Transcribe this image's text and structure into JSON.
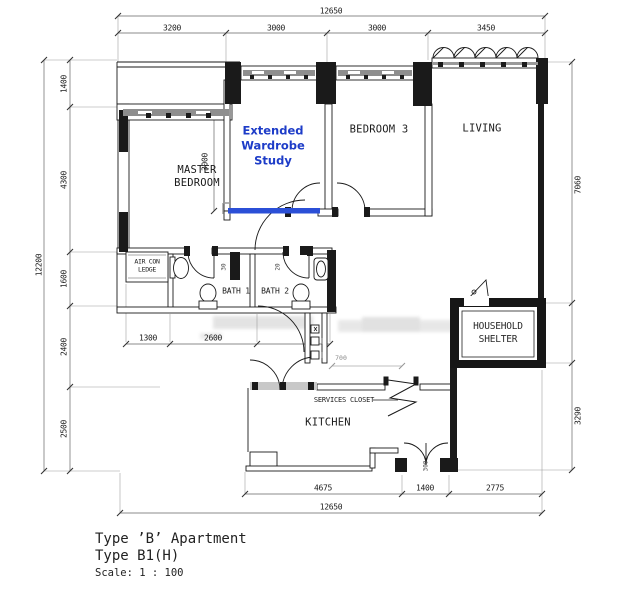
{
  "plan": {
    "rooms": {
      "master_bedroom_line1": "MASTER",
      "master_bedroom_line2": "BEDROOM",
      "extended_wardrobe_line1": "Extended",
      "extended_wardrobe_line2": "Wardrobe",
      "extended_wardrobe_line3": "Study",
      "bedroom3": "BEDROOM 3",
      "living": "LIVING",
      "bath1": "BATH 1",
      "bath2": "BATH 2",
      "kitchen": "KITCHEN",
      "services_closet": "SERVICES CLOSET",
      "household_shelter_line1": "HOUSEHOLD",
      "household_shelter_line2": "SHELTER",
      "aircon_ledge_line1": "AIR CON",
      "aircon_ledge_line2": "LEDGE"
    },
    "dimensions": {
      "top_overall": "12650",
      "top_segments": [
        "3200",
        "3000",
        "3000",
        "3450"
      ],
      "left_overall": "12200",
      "left_segments": [
        "1400",
        "4300",
        "1600",
        "2400",
        "2500"
      ],
      "right_segments": [
        "7060",
        "3290"
      ],
      "bottom_segments": [
        "4675",
        "1400",
        "2775"
      ],
      "bottom_overall": "12650",
      "interior_ews_depth": "3000",
      "interior_aircon": "1300",
      "interior_bath": "2600",
      "interior_services": "700",
      "door_marks": [
        "30",
        "20",
        "300"
      ]
    },
    "title_block": {
      "line1": "Type ’B’ Apartment",
      "line2": "Type B1(H)",
      "scale": "Scale: 1 : 100"
    },
    "colors": {
      "highlight_blue": "#2b4fd7",
      "label_blue": "#1d3cc8",
      "wall_black": "#1a1a1a",
      "window_gray": "#8e8e8e"
    }
  }
}
